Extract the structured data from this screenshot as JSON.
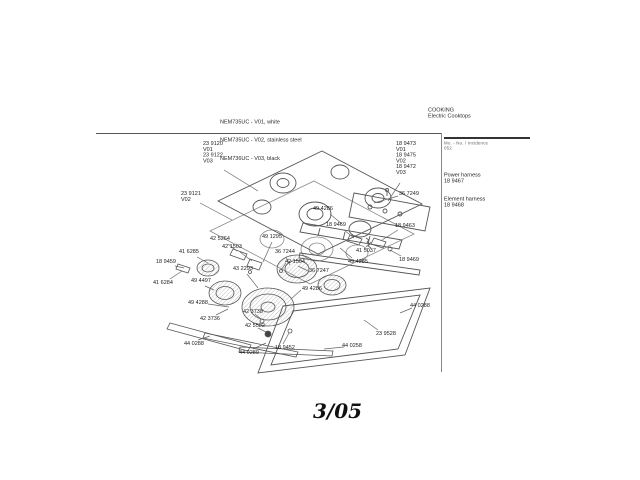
{
  "page": {
    "footer_date": "3/05"
  },
  "header": {
    "models": [
      "NEM735UC - V01, white",
      "NEM735UC - V02, stainless steel",
      "NEM736UC - V03, black"
    ],
    "category": "COOKING",
    "subcategory": "Electric Cooktops"
  },
  "sidebar": {
    "note_line1": "Mo. - No. / Incidence",
    "note_line2": "052",
    "entries": [
      {
        "name": "Power harness",
        "part_number": "18 9467"
      },
      {
        "name": "Element harness",
        "part_number": "18 9468"
      }
    ]
  },
  "diagram": {
    "labels": [
      {
        "text": "23 9120\nV01\n23 9122\nV03",
        "x": 203,
        "y": 141,
        "leader": [
          224,
          170,
          258,
          191
        ]
      },
      {
        "text": "23 9121\nV02",
        "x": 181,
        "y": 191,
        "leader": [
          200,
          203,
          232,
          220
        ]
      },
      {
        "text": "18 9473\nV01\n18 9475\nV02\n18 9472\nV03",
        "x": 396,
        "y": 141,
        "leader": [
          400,
          183,
          388,
          201
        ]
      },
      {
        "text": "36 7249",
        "x": 399,
        "y": 191,
        "leader": [
          398,
          196,
          374,
          203
        ]
      },
      {
        "text": "49 4286",
        "x": 313,
        "y": 206,
        "leader": [
          330,
          214,
          342,
          224
        ]
      },
      {
        "text": "18 9469",
        "x": 326,
        "y": 222,
        "leader": [
          344,
          230,
          354,
          238
        ]
      },
      {
        "text": "18 9463",
        "x": 395,
        "y": 223,
        "leader": [
          398,
          230,
          382,
          240
        ]
      },
      {
        "text": "41 5037",
        "x": 356,
        "y": 248,
        "leader": [
          366,
          247,
          371,
          242
        ]
      },
      {
        "text": "49 4285",
        "x": 348,
        "y": 259,
        "leader": [
          352,
          258,
          340,
          248
        ]
      },
      {
        "text": "18 9469",
        "x": 399,
        "y": 257,
        "leader": [
          401,
          256,
          390,
          250
        ]
      },
      {
        "text": "36 7247",
        "x": 309,
        "y": 268,
        "leader": [
          308,
          271,
          298,
          266
        ]
      },
      {
        "text": "42 5264",
        "x": 210,
        "y": 236,
        "leader": [
          228,
          244,
          237,
          251
        ]
      },
      {
        "text": "41 6285",
        "x": 179,
        "y": 249,
        "leader": [
          197,
          257,
          208,
          263
        ]
      },
      {
        "text": "42 1503",
        "x": 222,
        "y": 244,
        "leader": [
          240,
          252,
          252,
          261
        ]
      },
      {
        "text": "18 9459",
        "x": 156,
        "y": 259,
        "leader": [
          175,
          266,
          184,
          268
        ]
      },
      {
        "text": "41 6284",
        "x": 153,
        "y": 280,
        "leader": [
          170,
          279,
          182,
          271
        ]
      },
      {
        "text": "49 1295",
        "x": 262,
        "y": 234,
        "leader": [
          272,
          242,
          263,
          262
        ]
      },
      {
        "text": "36 7244",
        "x": 275,
        "y": 249,
        "leader": [
          286,
          257,
          290,
          265
        ]
      },
      {
        "text": "43 2293",
        "x": 233,
        "y": 266,
        "leader": [
          247,
          274,
          258,
          288
        ]
      },
      {
        "text": "42 1504",
        "x": 285,
        "y": 259,
        "leader": [
          286,
          263,
          281,
          270
        ]
      },
      {
        "text": "49 4497",
        "x": 191,
        "y": 278,
        "leader": [
          205,
          286,
          214,
          290
        ]
      },
      {
        "text": "49 4288",
        "x": 188,
        "y": 300,
        "leader": [
          208,
          304,
          229,
          307
        ]
      },
      {
        "text": "49 4286",
        "x": 302,
        "y": 286,
        "leader": [
          301,
          290,
          291,
          299
        ]
      },
      {
        "text": "42 3736",
        "x": 200,
        "y": 316,
        "leader": [
          216,
          315,
          228,
          309
        ]
      },
      {
        "text": "42 3738",
        "x": 243,
        "y": 309,
        "leader": [
          255,
          314,
          261,
          319
        ]
      },
      {
        "text": "42 5582",
        "x": 245,
        "y": 323,
        "leader": [
          258,
          328,
          266,
          332
        ]
      },
      {
        "text": "44 0288",
        "x": 184,
        "y": 341,
        "leader": [
          198,
          340,
          210,
          336
        ]
      },
      {
        "text": "44 0289",
        "x": 239,
        "y": 350,
        "leader": [
          253,
          349,
          266,
          343
        ]
      },
      {
        "text": "18 9452",
        "x": 275,
        "y": 345,
        "leader": [
          283,
          344,
          289,
          333
        ]
      },
      {
        "text": "44 0288",
        "x": 410,
        "y": 303,
        "leader": [
          412,
          308,
          400,
          313
        ]
      },
      {
        "text": "23 9528",
        "x": 376,
        "y": 331,
        "leader": [
          378,
          330,
          364,
          320
        ]
      },
      {
        "text": "44 0258",
        "x": 342,
        "y": 343,
        "leader": [
          344,
          347,
          324,
          349
        ]
      }
    ]
  }
}
